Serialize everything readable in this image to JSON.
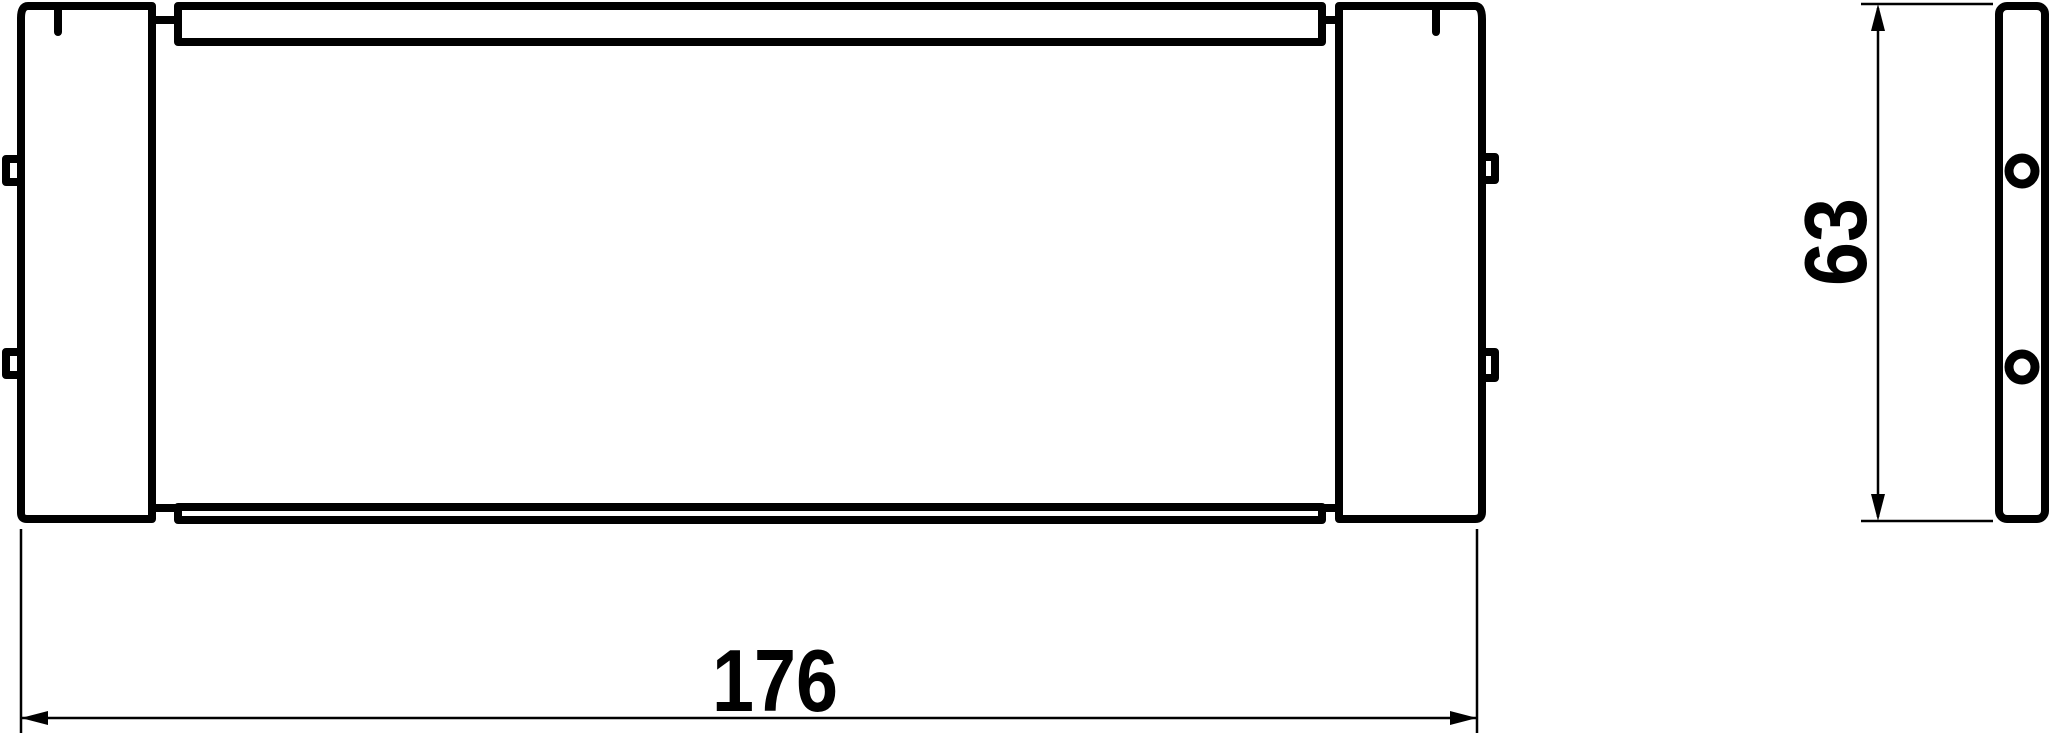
{
  "page": {
    "background_color": "#ffffff",
    "line_color": "#000000"
  },
  "drawing": {
    "type": "orthographic-technical-drawing",
    "front_view": {
      "id": "front-view",
      "end_blocks": 2,
      "side_tabs_per_block": 2,
      "bend_marks": 2
    },
    "side_view": {
      "id": "side-view",
      "hole_count": 2
    },
    "dimensions": [
      {
        "label": "176",
        "orientation": "horizontal",
        "measures": "overall-width"
      },
      {
        "label": "63",
        "orientation": "vertical",
        "measures": "overall-height"
      }
    ]
  }
}
